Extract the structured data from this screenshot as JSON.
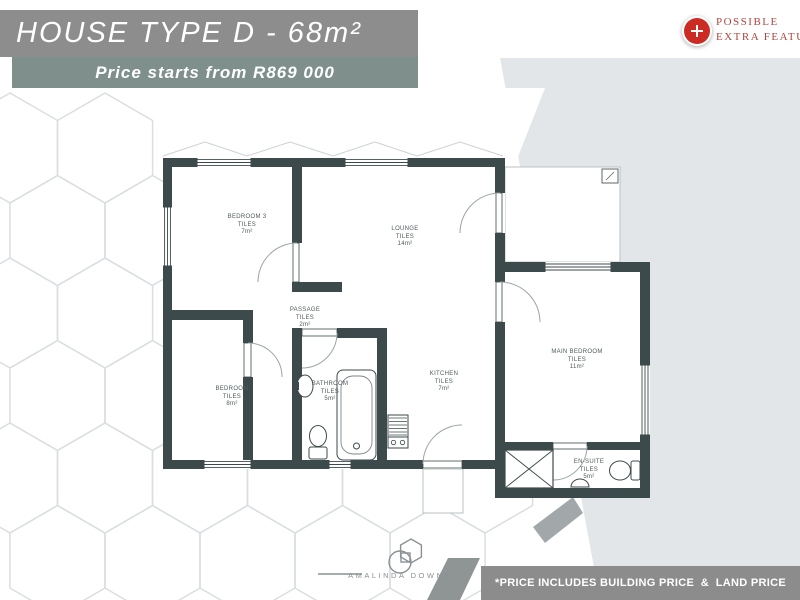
{
  "header": {
    "title": "HOUSE TYPE D - 68m²",
    "title_bg": "#8d8d8d",
    "price": "Price starts from R869 000",
    "price_bg": "#7e8f8c"
  },
  "extra_feature_badge": {
    "icon": "plus-icon",
    "icon_color": "#cb2b22",
    "text_color": "#b2443e",
    "line1": "POSSIBLE",
    "line2": "EXTRA FEATURES"
  },
  "floorplan": {
    "wall_color": "#3d4a4b",
    "rooms": [
      {
        "id": "bedroom-3",
        "name": "BEDROOM 3",
        "floor": "TILES",
        "area": "7m²"
      },
      {
        "id": "lounge",
        "name": "LOUNGE",
        "floor": "TILES",
        "area": "14m²"
      },
      {
        "id": "passage",
        "name": "PASSAGE",
        "floor": "TILES",
        "area": "2m²"
      },
      {
        "id": "bedroom",
        "name": "BEDROOM",
        "floor": "TILES",
        "area": "8m²"
      },
      {
        "id": "bathroom",
        "name": "BATHROOM",
        "floor": "TILES",
        "area": "5m²"
      },
      {
        "id": "kitchen",
        "name": "KITCHEN",
        "floor": "TILES",
        "area": "7m²"
      },
      {
        "id": "main-bedroom",
        "name": "MAIN BEDROOM",
        "floor": "TILES",
        "area": "11m²"
      },
      {
        "id": "en-suite",
        "name": "EN-SUITE",
        "floor": "TILES",
        "area": "5m²"
      }
    ]
  },
  "footer": {
    "logo": "AMALINDA DOWNS",
    "disclaimer": "*PRICE INCLUDES BUILDING PRICE  &  LAND PRICE",
    "disclaimer_bg": "#8c8c8c"
  }
}
